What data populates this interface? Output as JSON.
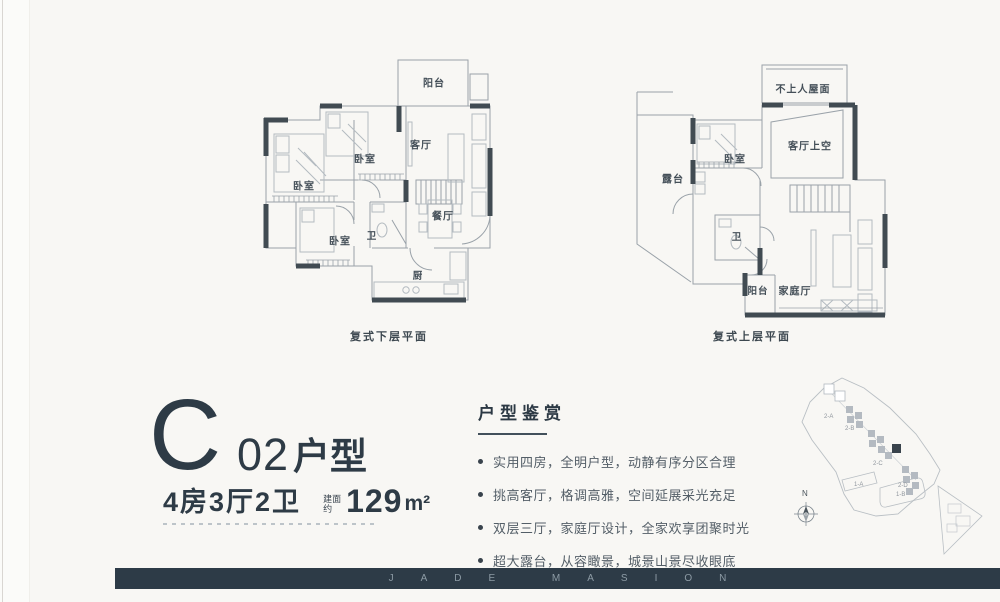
{
  "unit_info": {
    "letter": "C",
    "code": "02",
    "type_label": "户型",
    "rooms_summary": "4房3厅2卫",
    "area_prefix": "建面约",
    "area_value": "129",
    "area_unit": "m²"
  },
  "plan_lower": {
    "caption": "复式下层平面",
    "rooms": {
      "balcony": "阳台",
      "living": "客厅",
      "bedroom_mid": "卧室",
      "bedroom_left": "卧室",
      "bedroom_bottom": "卧室",
      "bath": "卫",
      "dining": "餐厅",
      "kitchen": "厨"
    }
  },
  "plan_upper": {
    "caption": "复式上层平面",
    "rooms": {
      "roof": "不上人屋面",
      "void": "客厅上空",
      "bedroom": "卧室",
      "terrace": "露台",
      "bath": "卫",
      "balcony": "阳台",
      "family": "家庭厅"
    }
  },
  "appreciation": {
    "title": "户型鉴赏",
    "bullets": [
      "实用四房，全明户型，动静有序分区合理",
      "挑高客厅，格调高雅，空间延展采光充足",
      "双层三厅，家庭厅设计，全家欢享团聚时光",
      "超大露台，从容瞰景，城景山景尽收眼底"
    ]
  },
  "site_map": {
    "north_label": "N",
    "building_labels": [
      "2-A",
      "2-B",
      "2-C",
      "2-D",
      "1-A",
      "1-B"
    ]
  },
  "footer": {
    "brand_text": "JADE MASION"
  },
  "colors": {
    "accent_dark": "#2e3b46",
    "bar_bg": "#2d3b47",
    "wall_dark": "#414b52",
    "plan_line": "#9aa2a9",
    "text_gray": "#535e67"
  }
}
